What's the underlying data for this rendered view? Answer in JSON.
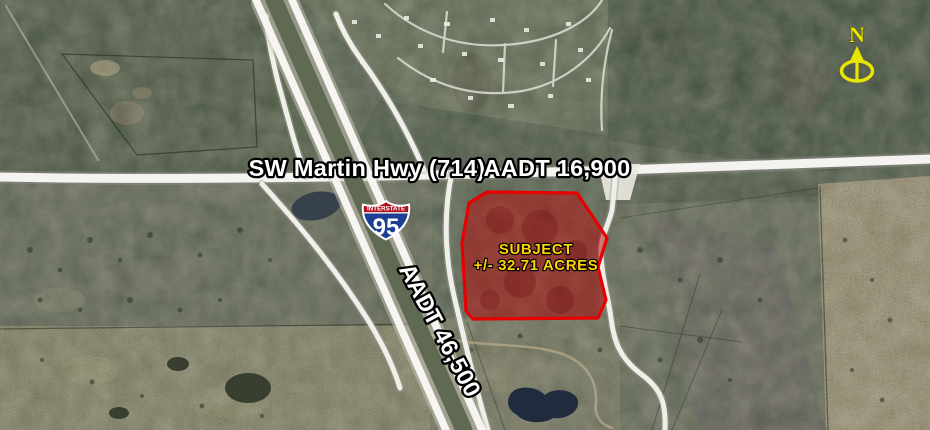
{
  "road_labels": {
    "highway_name": "SW Martin Hwy (714)",
    "highway_aadt": "AADT 16,900",
    "i95_aadt": "AADT 46,500"
  },
  "subject_parcel": {
    "title": "SUBJECT",
    "area": "+/- 32.71 ACRES",
    "outline_color": "#e60000",
    "fill_color": "#b51414",
    "label_color": "#ffd400"
  },
  "interstate_shield": {
    "banner": "INTERSTATE",
    "route_number": "95",
    "banner_color": "#b0121c",
    "shield_color": "#1c3f94"
  },
  "compass": {
    "label": "N",
    "color": "#e9e400"
  }
}
